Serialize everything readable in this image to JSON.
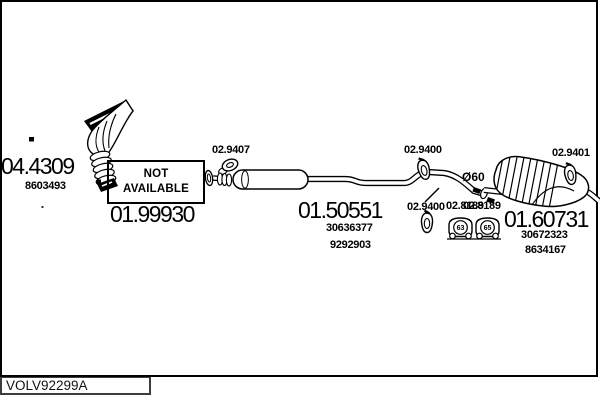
{
  "parts": {
    "manifold": {
      "number": "04.4309",
      "oe": [
        "8603493"
      ]
    },
    "front": {
      "number": "01.99930",
      "status_line1": "NOT",
      "status_line2": "AVAILABLE"
    },
    "middle": {
      "number": "01.50551",
      "oe": [
        "30636377",
        "9292903"
      ]
    },
    "rear": {
      "number": "01.60731",
      "oe": [
        "30672323",
        "8634167"
      ]
    }
  },
  "fittings": {
    "gasket": "02.9407",
    "hanger_top": "02.9400",
    "hanger_bottom": "02.9400",
    "hanger_rear": "02.9401",
    "mount_label_a": "02.8189",
    "mount_label_b": "02.8189",
    "mount_digit_left": "63",
    "mount_digit_right": "65"
  },
  "pipe": {
    "diameter_note": "Ø60"
  },
  "footer": {
    "code": "VOLV92299A"
  },
  "colors": {
    "ink": "#000000",
    "background": "#ffffff"
  }
}
